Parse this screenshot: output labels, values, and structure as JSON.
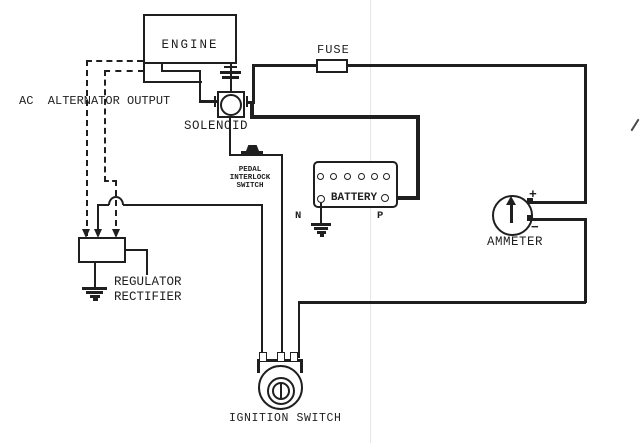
{
  "diagram": {
    "type": "wiring-diagram",
    "colors": {
      "ink": "#1f1f1f",
      "paper": "#ffffff",
      "fold": "#e6e6e2",
      "pen_mark": "#4a4a4a"
    },
    "labels": {
      "engine": "ENGINE",
      "ac_alternator_output": "AC  ALTERNATOR OUTPUT",
      "solenoid": "SOLENOID",
      "fuse": "FUSE",
      "pedal_line1": "PEDAL",
      "pedal_line2": "INTERLOCK",
      "pedal_line3": "SWITCH",
      "battery": "BATTERY",
      "battery_negative": "N",
      "battery_positive": "P",
      "ammeter": "AMMETER",
      "ammeter_positive": "+",
      "ammeter_negative": "−",
      "regulator_line1": "REGULATOR",
      "regulator_line2": "RECTIFIER",
      "ignition_switch": "IGNITION SWITCH"
    }
  }
}
